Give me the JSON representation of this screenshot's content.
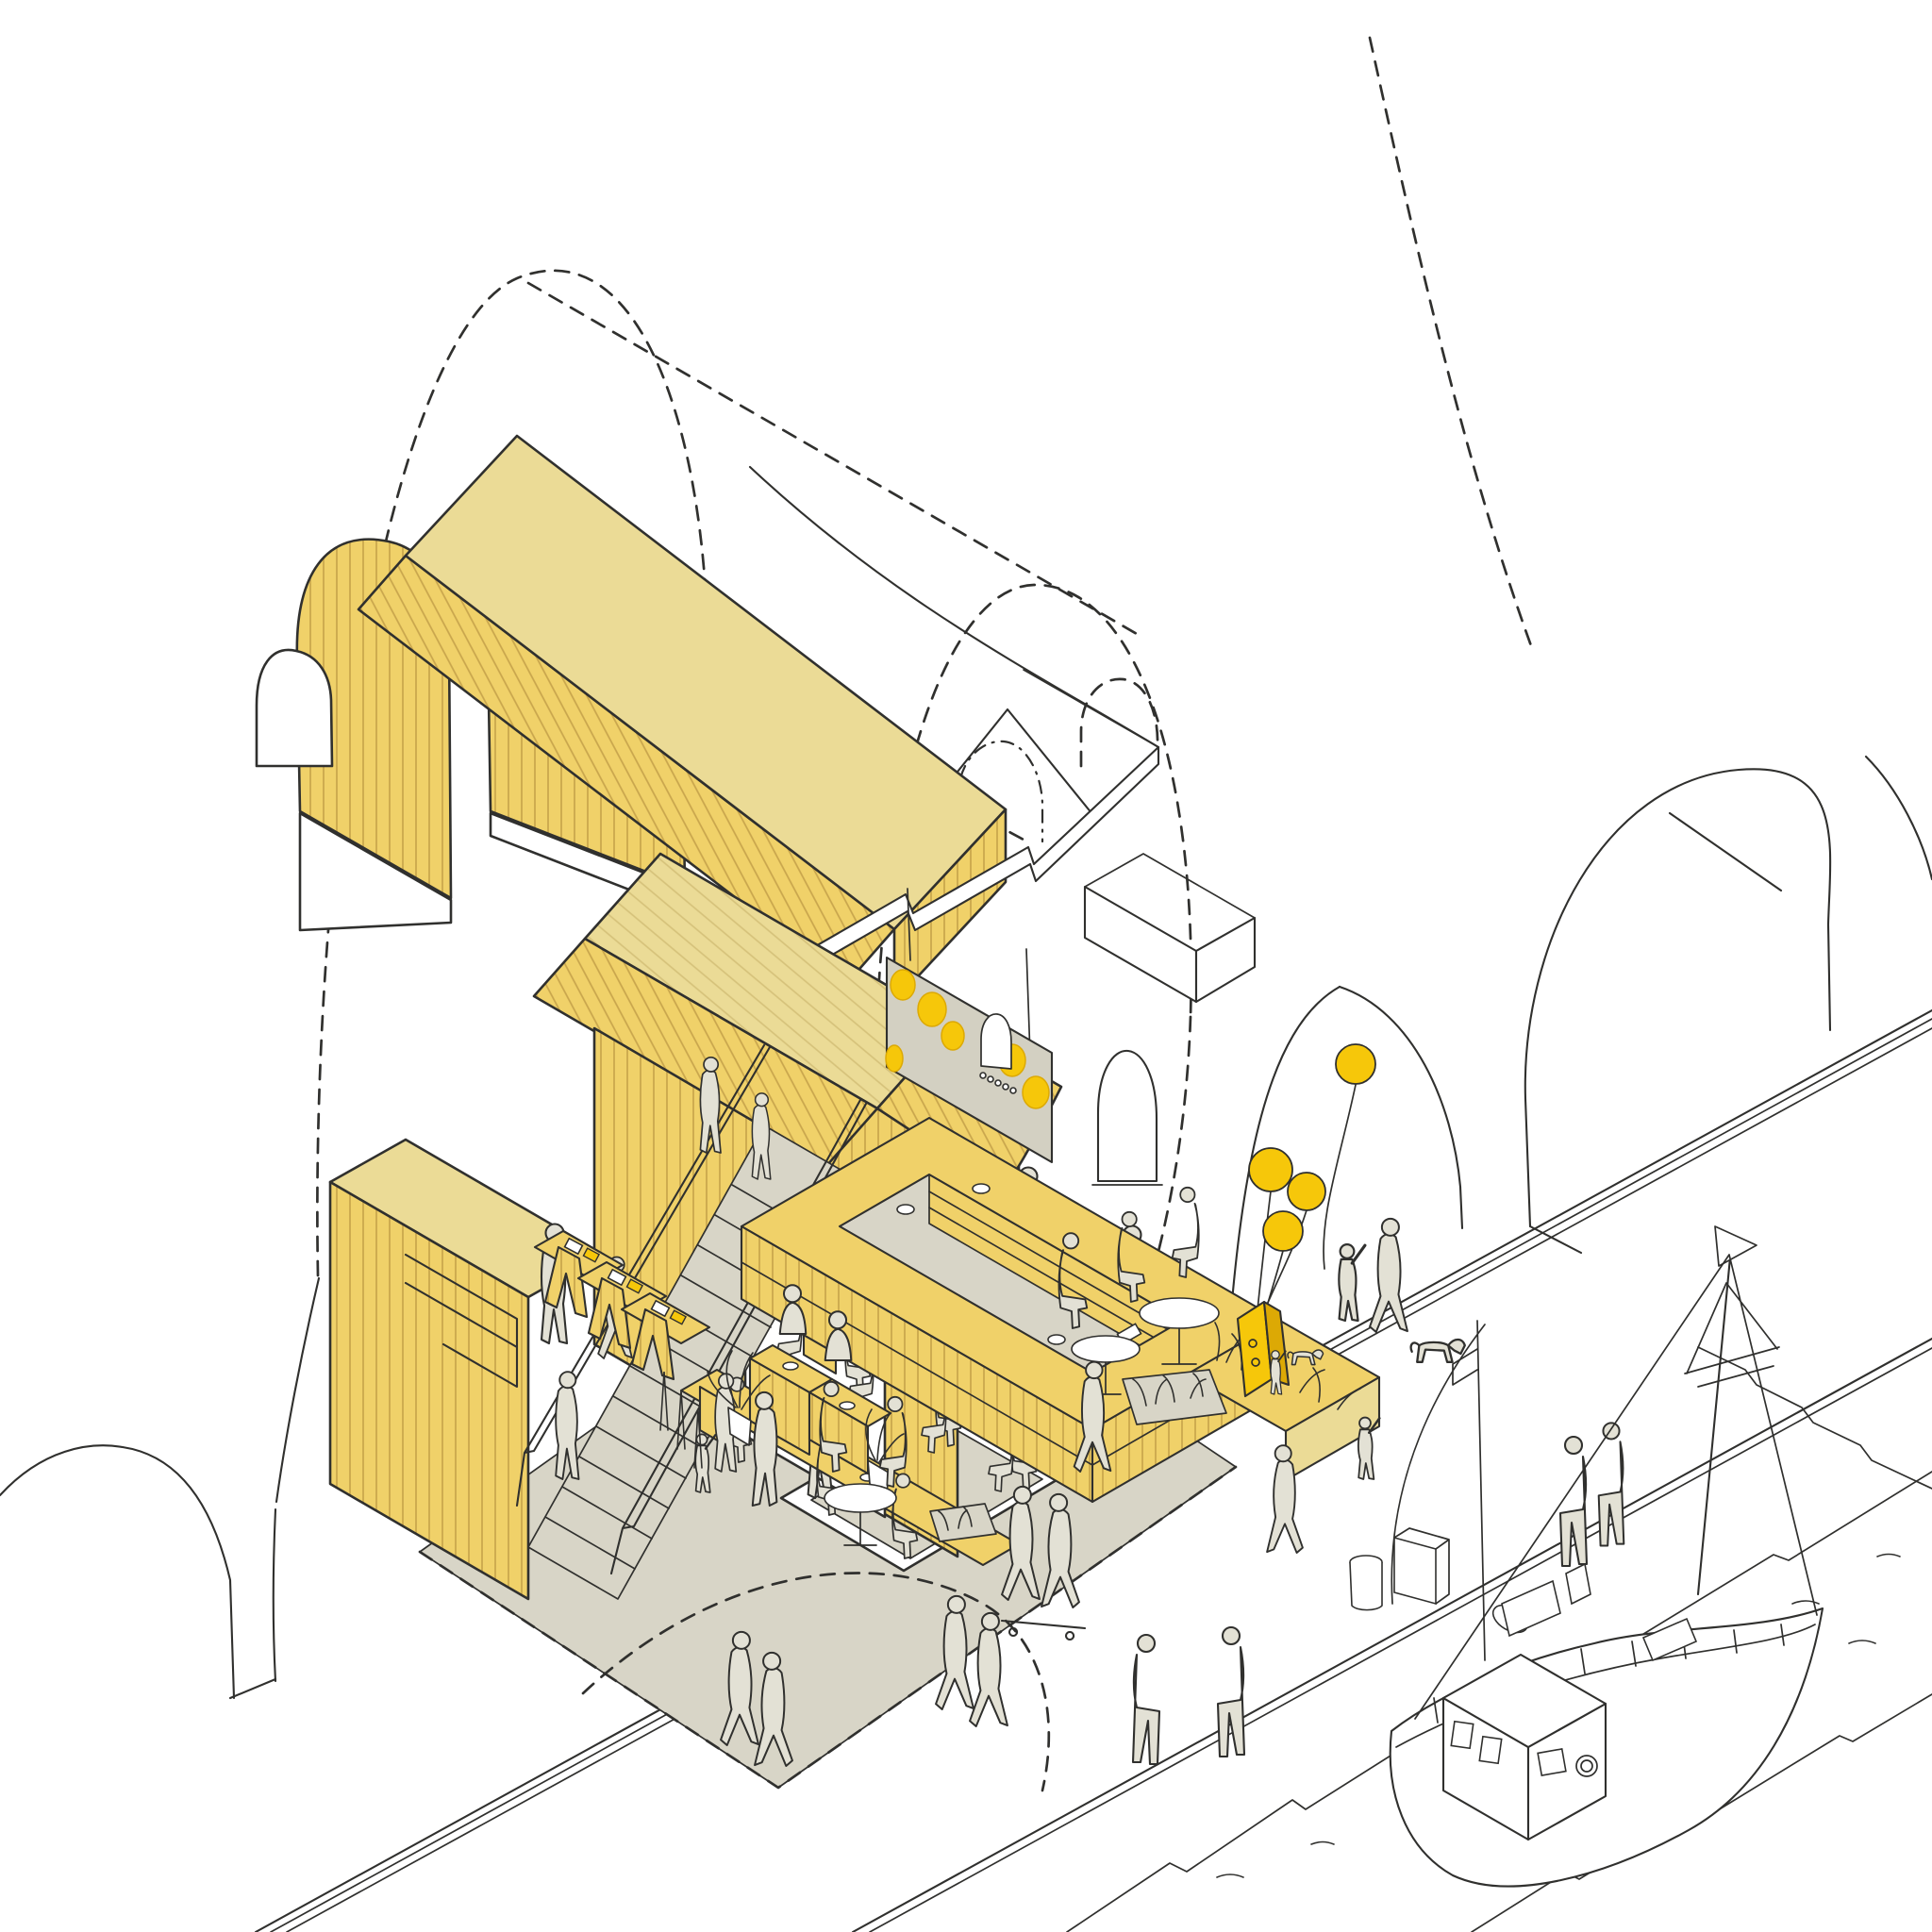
{
  "title": "Exploded axonometric sketch — railway-arch food hall on a quayside promenade",
  "palette": {
    "paper": "#ffffff",
    "ink": "#30302e",
    "ink_light": "#55544f",
    "cladding": "#f0d169",
    "cladding_line": "#c8a54c",
    "roof_pale": "#ebdb96",
    "pale_line": "#d5c179",
    "accent": "#f6c70a",
    "accent_deep": "#dca905",
    "floor": "#d8d5c7",
    "screen": "#d3d0c2",
    "figure": "#e3e1d5"
  },
  "scene": {
    "drawing_style": "hand-drawn line sketch, yellow highlights on white",
    "building": {
      "envelope": "brick railway arch shown as dashed outline",
      "lifted_pieces": [
        "double barrel-vault timber roof shell",
        "first-floor slab plate"
      ],
      "ground_floor": {
        "stair": "straight timber stair with handrails",
        "door": "arched opening cut in boarded wall",
        "communal_dining_tables": 2,
        "retail_display_tables": 3,
        "bar_island": "rectangular counter with inner service pit and shelving",
        "bar_planter": "grasses at the outer end",
        "perforated_screen": {
          "holes": 6,
          "arched_niche": 1
        },
        "clerestory_windows": 5,
        "service_kiosk_counters": 2,
        "potted_plants": 3
      }
    },
    "promenade": {
      "paving_bands": 3,
      "a_board_sign": 1,
      "balloons_tied_to_sign": 3,
      "balloon_floating": 1,
      "litter_bins": 2,
      "dogs": 2,
      "skateboarders": 2,
      "planting_beds": 2,
      "outdoor_round_tables": 3
    },
    "water": {
      "boats": 1,
      "boat_type": "small moored fishing boat with mast and rigging",
      "quay_edge_sitters": 4
    },
    "context": {
      "arches_sketched_right": 3,
      "arches_sketched_left": 1
    },
    "figures_approximate_count": 40
  }
}
